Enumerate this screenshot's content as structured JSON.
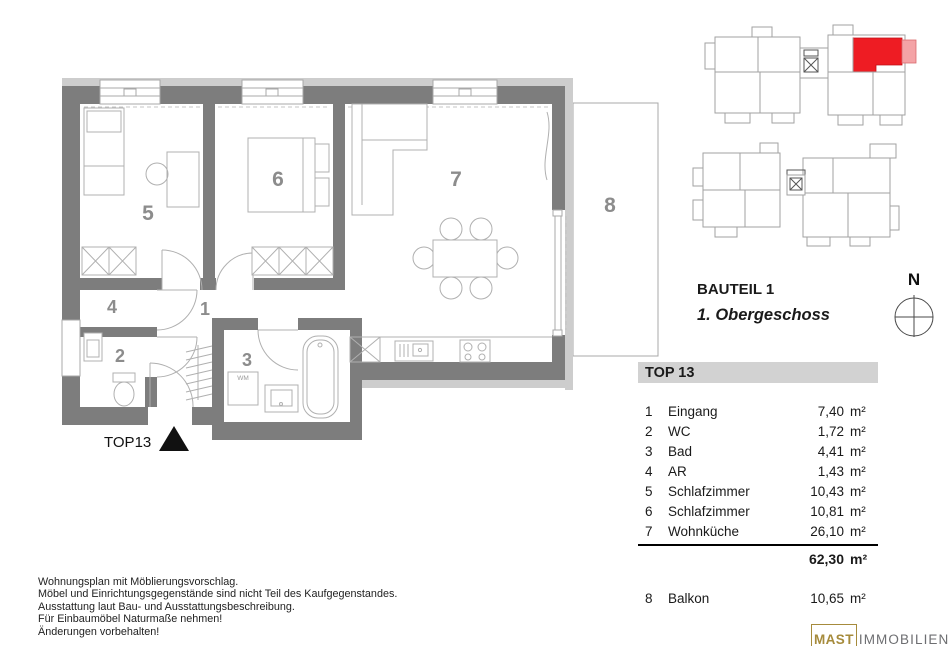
{
  "colors": {
    "wall": "#7d7d7d",
    "wall_light": "#cdcdcd",
    "line": "#a8a8a8",
    "furniture": "#b0b0b0",
    "room_number": "#8c8c8c",
    "highlight": "#ee1c23",
    "highlight_light": "#f4a3a6",
    "legend_bar": "#d2d2d2",
    "text": "#1a1a1a",
    "logo_gold": "#a68b3c",
    "logo_gray": "#6d6e71"
  },
  "plan": {
    "unit_label": "TOP13",
    "room_numbers": [
      "1",
      "2",
      "3",
      "4",
      "5",
      "6",
      "7",
      "8"
    ],
    "wm_label": "WM"
  },
  "section": {
    "bauteil": "BAUTEIL 1",
    "floor": "1. Obergeschoss"
  },
  "compass": {
    "label": "N"
  },
  "legend": {
    "title": "TOP 13",
    "rows": [
      {
        "nr": "1",
        "name": "Eingang",
        "area": "7,40",
        "unit": "m²"
      },
      {
        "nr": "2",
        "name": "WC",
        "area": "1,72",
        "unit": "m²"
      },
      {
        "nr": "3",
        "name": "Bad",
        "area": "4,41",
        "unit": "m²"
      },
      {
        "nr": "4",
        "name": "AR",
        "area": "1,43",
        "unit": "m²"
      },
      {
        "nr": "5",
        "name": "Schlafzimmer",
        "area": "10,43",
        "unit": "m²"
      },
      {
        "nr": "6",
        "name": "Schlafzimmer",
        "area": "10,81",
        "unit": "m²"
      },
      {
        "nr": "7",
        "name": "Wohnküche",
        "area": "26,10",
        "unit": "m²"
      }
    ],
    "total": {
      "area": "62,30",
      "unit": "m²"
    },
    "outdoor": {
      "nr": "8",
      "name": "Balkon",
      "area": "10,65",
      "unit": "m²"
    }
  },
  "footer": {
    "lines": [
      "Wohnungsplan mit Möblierungsvorschlag.",
      "Möbel und Einrichtungsgegenstände sind nicht Teil des Kaufgegenstandes.",
      "Ausstattung laut Bau- und Ausstattungsbeschreibung.",
      "Für Einbaumöbel Naturmaße nehmen!",
      "Änderungen vorbehalten!"
    ]
  },
  "logo": {
    "name": "MAST",
    "suffix": "IMMOBILIEN"
  }
}
